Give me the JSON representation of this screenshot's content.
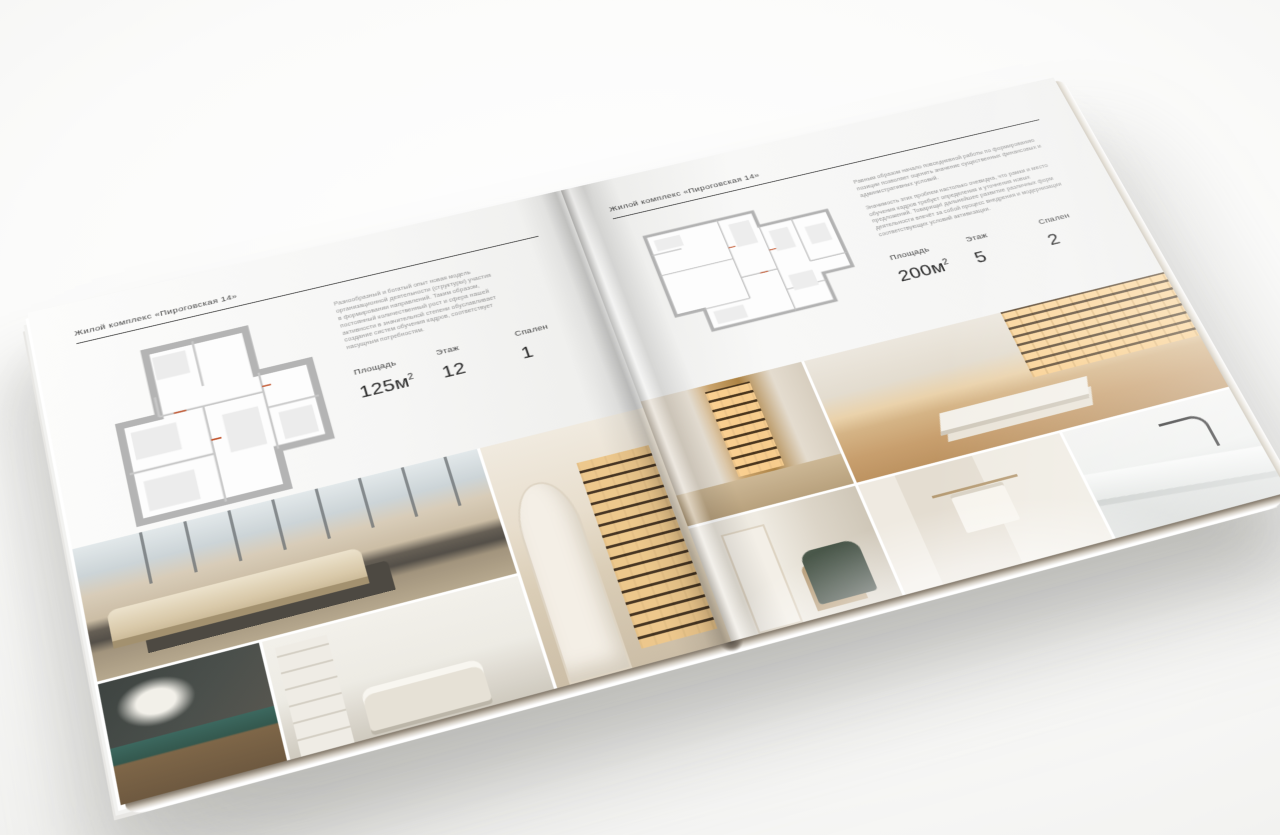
{
  "meta": {
    "background_color": "#f7f7f5",
    "page_color": "#f6f6f5",
    "text_dark": "#262626",
    "text_muted": "#939393",
    "rule_color": "#343434",
    "plan_wall_color": "#b4b4b4",
    "plan_accent_color": "#c2562f"
  },
  "brochure": {
    "left_page": {
      "header": "Жилой комплекс «Пироговская 14»",
      "description": "Разнообразный и богатый опыт новая модель организационной деятельности (структуры) участия в формировании направлений. Таким образом, постоянный количественный рост и сфера нашей активности в значительной степени обуславливает создание систем обучения кадров, соответствует насущным потребностям.",
      "stats": [
        {
          "label": "Площадь",
          "value": "125м",
          "sup": "2"
        },
        {
          "label": "Этаж",
          "value": "12",
          "sup": ""
        },
        {
          "label": "Спален",
          "value": "1",
          "sup": ""
        }
      ],
      "photos": [
        "bedroom-with-city-view",
        "library-corridor",
        "dark-dresser-with-flowers",
        "white-bedroom"
      ]
    },
    "right_page": {
      "header": "Жилой комплекс «Пироговская 14»",
      "description_1": "Равным образом начало повседневной работы по формированию позиции позволяет оценить значение существенных финансовых и административных условий.",
      "description_2": "Значимость этих проблем настолько очевидна, что рамки и место обучения кадров требует определения и уточнения новых предложений. Товарищи! дальнейшее развитие различных форм деятельности влечёт за собой процесс внедрения и модернизации соответствующих условий активизации.",
      "stats": [
        {
          "label": "Площадь",
          "value": "200м",
          "sup": "2"
        },
        {
          "label": "Этаж",
          "value": "5",
          "sup": ""
        },
        {
          "label": "Спален",
          "value": "2",
          "sup": ""
        }
      ],
      "photos": [
        "walk-in-closet",
        "hall-with-armchair",
        "study-with-desk",
        "bathroom-towel-rail",
        "marble-washbasin"
      ]
    }
  }
}
